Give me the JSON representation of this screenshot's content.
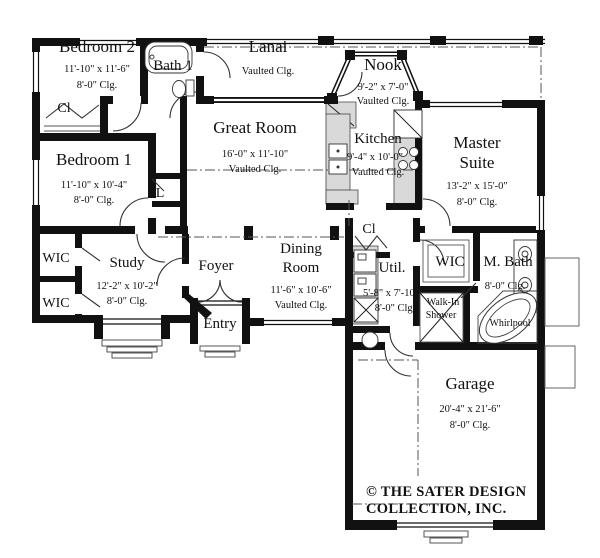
{
  "plan": {
    "title": "Single-story house floor plan",
    "rooms": {
      "bedroom2": {
        "name": "Bedroom 2",
        "dims": "11'-10\" x 11'-6\"",
        "ceiling": "8'-0\" Clg."
      },
      "bath1": {
        "name": "Bath 1"
      },
      "lanai": {
        "name": "Lanai",
        "ceiling": "Vaulted Clg."
      },
      "nook": {
        "name": "Nook",
        "dims": "9'-2\" x 7'-0\"",
        "ceiling": "Vaulted Clg."
      },
      "great_room": {
        "name": "Great Room",
        "dims": "16'-0\" x 11'-10\"",
        "ceiling": "Vaulted Clg."
      },
      "kitchen": {
        "name": "Kitchen",
        "dims": "9'-4\" x 10'-0\"",
        "ceiling": "Vaulted Clg."
      },
      "master_suite": {
        "line1": "Master",
        "line2": "Suite",
        "dims": "13'-2\" x 15'-0\"",
        "ceiling": "8'-0\" Clg."
      },
      "bedroom1": {
        "name": "Bedroom 1",
        "dims": "11'-10\" x 10'-4\"",
        "ceiling": "8'-0\" Clg."
      },
      "study": {
        "name": "Study",
        "dims": "12'-2\" x 10'-2\"",
        "ceiling": "8'-0\" Clg."
      },
      "foyer": {
        "name": "Foyer"
      },
      "entry": {
        "name": "Entry"
      },
      "dining_room": {
        "line1": "Dining",
        "line2": "Room",
        "dims": "11'-6\" x 10'-6\"",
        "ceiling": "Vaulted Clg."
      },
      "util": {
        "name": "Util.",
        "dims": "5'-8\" x 7'-10\"",
        "ceiling": "8'-0\" Clg."
      },
      "wic_master": {
        "name": "WIC"
      },
      "m_bath": {
        "name": "M. Bath",
        "ceiling": "8'-0\" Clg."
      },
      "walk_in_shower": {
        "line1": "Walk-In",
        "line2": "Shower"
      },
      "whirlpool": {
        "name": "Whirlpool"
      },
      "garage": {
        "name": "Garage",
        "dims": "20'-4\" x 21'-6\"",
        "ceiling": "8'-0\" Clg."
      },
      "closet_bedroom2": {
        "name": "Cl"
      },
      "closet_hall": {
        "name": "Cl"
      },
      "linen": {
        "name": "L"
      },
      "wic_1": {
        "name": "WIC"
      },
      "wic_2": {
        "name": "WIC"
      }
    },
    "copyright": {
      "line1": "© THE SATER DESIGN",
      "line2": "COLLECTION, INC."
    },
    "fixtures": [
      "bathtub-icon",
      "toilet-icon",
      "kitchen-sink-icon",
      "cooktop-icon",
      "refrigerator-icon",
      "pantry-counter-icon",
      "washer-dryer-icon",
      "laundry-tub-icon",
      "water-heater-icon",
      "closet-shelves-icon",
      "vanity-sinks-icon",
      "whirlpool-tub-icon",
      "walk-in-shower-icon",
      "bifold-door-icon",
      "steps-icon"
    ],
    "colors": {
      "line": "#111111",
      "background": "#ffffff",
      "counter_gray": "#d9d9d9"
    }
  }
}
